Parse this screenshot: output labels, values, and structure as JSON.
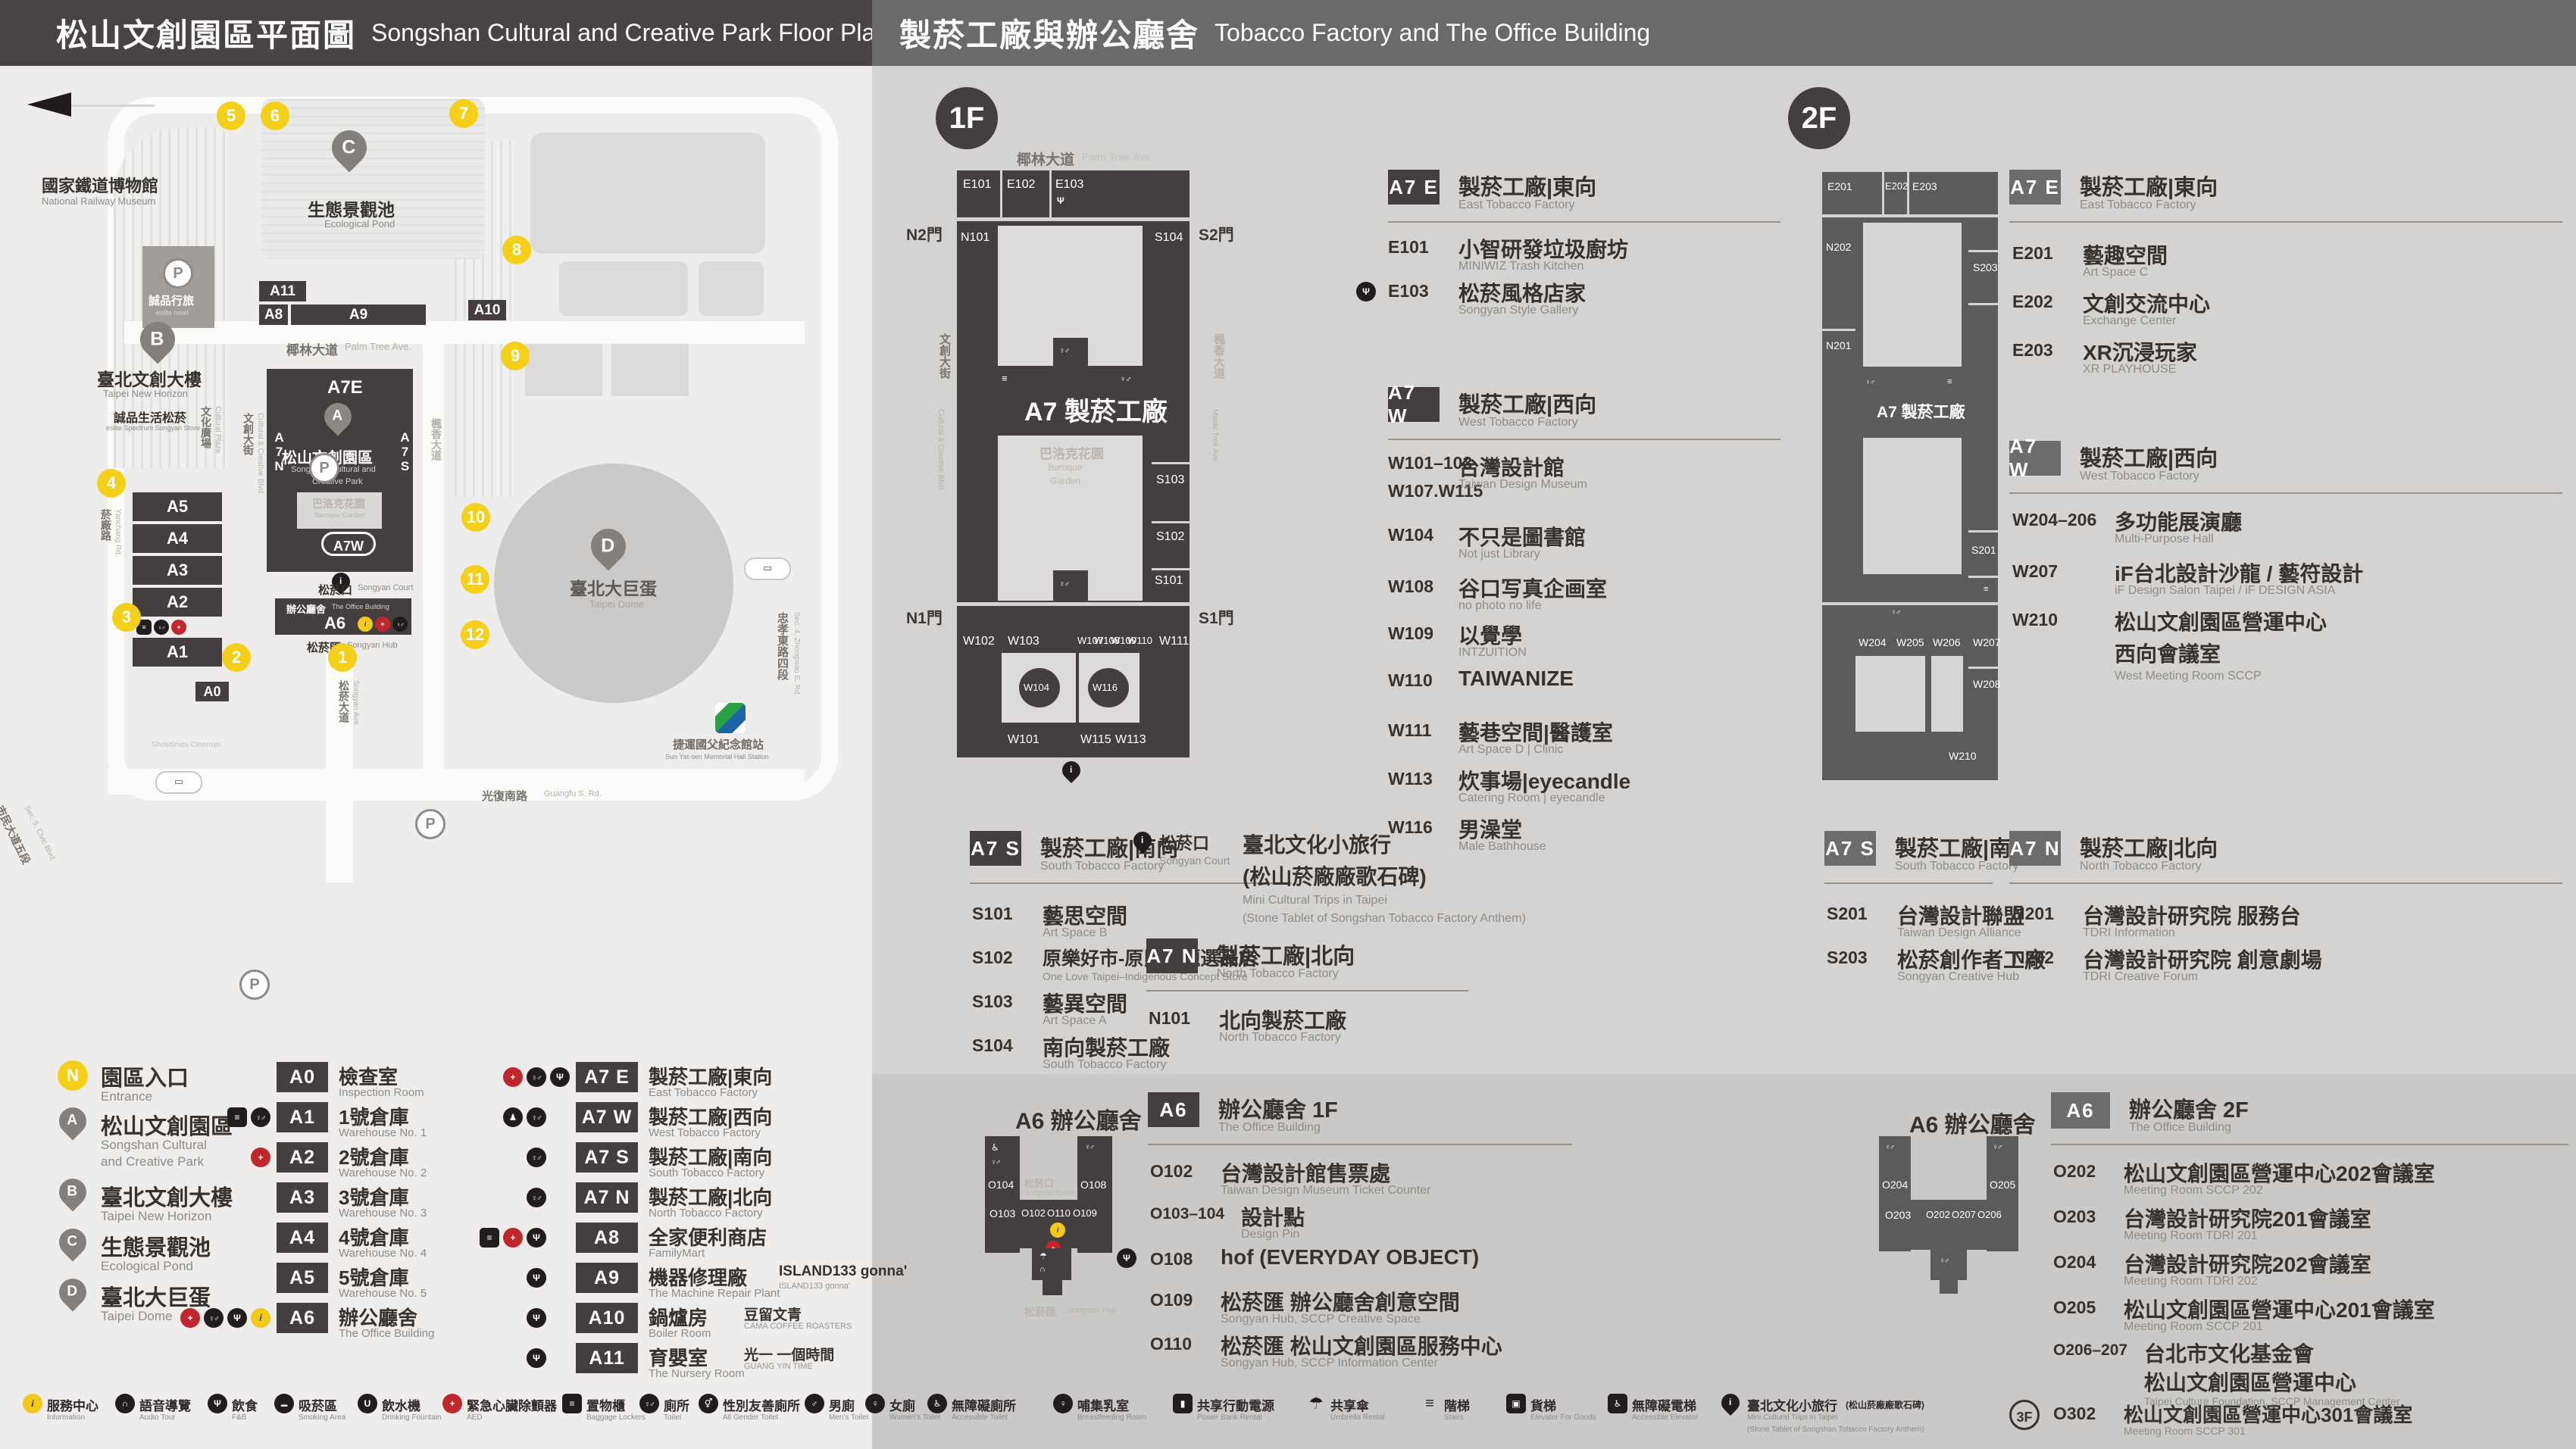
{
  "header_left": {
    "zh": "松山文創園區平面圖",
    "en": "Songshan Cultural and Creative Park Floor Plan"
  },
  "header_right": {
    "zh": "製菸工廠與辦公廳舍",
    "en": "Tobacco Factory and The Office Building"
  },
  "park": {
    "entrances": [
      "1",
      "2",
      "3",
      "4",
      "5",
      "6",
      "7",
      "8",
      "9",
      "10",
      "11",
      "12"
    ],
    "pins": {
      "a": "A",
      "b": "B",
      "c": "C",
      "d": "D"
    },
    "blocks": {
      "a0": "A0",
      "a1": "A1",
      "a2": "A2",
      "a3": "A3",
      "a4": "A4",
      "a5": "A5",
      "a6": "A6",
      "a8": "A8",
      "a9": "A9",
      "a10": "A10",
      "a11": "A11",
      "a7e": "A7E",
      "a7w": "A7W",
      "a7n": "A7N",
      "a7s": "A7S"
    },
    "labels": {
      "railway_museum_zh": "國家鐵道博物館",
      "railway_museum_en": "National Railway Museum",
      "pond_zh": "生態景觀池",
      "pond_en": "Ecological Pond",
      "eslite_hotel_zh": "誠品行旅",
      "eslite_hotel_en": "eslite hotel",
      "new_horizon_zh": "臺北文創大樓",
      "new_horizon_en": "Taipei New Horizon",
      "eslite_spectrum_zh": "誠品生活松菸",
      "eslite_spectrum_en": "eslite Spectrum Songyan Store",
      "park_zh": "松山文創園區",
      "park_en1": "Songshan Cultural and",
      "park_en2": "Creative Park",
      "baroque_zh": "巴洛克花園",
      "baroque_en": "Baroque Garden",
      "court_zh": "松菸口",
      "court_en": "Songyan Court",
      "office_zh": "辦公廳舍",
      "office_en": "The Office Building",
      "hub_zh": "松菸匯",
      "hub_en": "Songyan Hub",
      "dome_zh": "臺北大巨蛋",
      "dome_en": "Taipei Dome",
      "garden_city": "遠東Garden City",
      "showtimes_zh": "秀泰影城",
      "showtimes_en": "Showtimes Cinemas",
      "hotel_ic": "臺北洲際酒店",
      "dome_center": "巨蛋國際中心",
      "mrt_zh": "捷運國父紀念館站",
      "mrt_en": "Sun Yat-sen Memorial Hall Station"
    },
    "streets": {
      "palm_zh": "椰林大道",
      "palm_en": "Palm Tree Ave.",
      "cultural_blvd_zh": "文創大街",
      "cultural_blvd_en": "Cultural & Creative Blvd.",
      "cultural_plaza_zh": "文化廣場",
      "cultural_plaza_en": "Cultural Plaza",
      "yanchang_zh": "菸廠路",
      "yanchang_en": "Yanchang Rd.",
      "civic_zh": "市民大道五段",
      "civic_en": "Sec. 5, Civic Blvd.",
      "maple_zh": "楓香大道",
      "maple_en": "Maple Tree Ave.",
      "songyan_zh": "松菸大道",
      "songyan_en": "Songyan Ave.",
      "zhongxiao_zh": "忠孝東路四段",
      "zhongxiao_en": "Sec. 4, Zhongxiao E. Rd.",
      "guangfu_zh": "光復南路",
      "guangfu_en": "Guangfu S. Rd."
    }
  },
  "legend": {
    "points": [
      {
        "badge": "N",
        "zh": "園區入口",
        "en": "Entrance"
      },
      {
        "badge": "A",
        "zh": "松山文創園區",
        "en1": "Songshan Cultural",
        "en2": "and Creative Park"
      },
      {
        "badge": "B",
        "zh": "臺北文創大樓",
        "en": "Taipei New Horizon"
      },
      {
        "badge": "C",
        "zh": "生態景觀池",
        "en": "Ecological Pond"
      },
      {
        "badge": "D",
        "zh": "臺北大巨蛋",
        "en": "Taipei Dome"
      }
    ],
    "blocks": [
      {
        "code": "A0",
        "zh": "檢查室",
        "en": "Inspection Room"
      },
      {
        "code": "A1",
        "zh": "1號倉庫",
        "en": "Warehouse No. 1"
      },
      {
        "code": "A2",
        "zh": "2號倉庫",
        "en": "Warehouse No. 2"
      },
      {
        "code": "A3",
        "zh": "3號倉庫",
        "en": "Warehouse No. 3"
      },
      {
        "code": "A4",
        "zh": "4號倉庫",
        "en": "Warehouse No. 4"
      },
      {
        "code": "A5",
        "zh": "5號倉庫",
        "en": "Warehouse No. 5"
      },
      {
        "code": "A6",
        "zh": "辦公廳舍",
        "en": "The Office Building"
      }
    ],
    "areas": [
      {
        "code": "A7 E",
        "zh": "製菸工廠|東向",
        "en": "East Tobacco Factory"
      },
      {
        "code": "A7 W",
        "zh": "製菸工廠|西向",
        "en": "West Tobacco Factory"
      },
      {
        "code": "A7 S",
        "zh": "製菸工廠|南向",
        "en": "South Tobacco Factory"
      },
      {
        "code": "A7 N",
        "zh": "製菸工廠|北向",
        "en": "North Tobacco Factory"
      },
      {
        "code": "A8",
        "zh": "全家便利商店",
        "en": "FamilyMart"
      },
      {
        "code": "A9",
        "zh": "機器修理廠",
        "brand": "ISLAND133 gonna'",
        "brand_en": "ISLAND133 gonna'",
        "en": "The Machine Repair Plant"
      },
      {
        "code": "A10",
        "zh": "鍋爐房",
        "brand": "豆留文青",
        "brand_en": "CAMA COFFEE ROASTERS",
        "en": "Boiler Room"
      },
      {
        "code": "A11",
        "zh": "育嬰室",
        "brand": "光一 一個時間",
        "brand_en": "GUANG YIN TIME",
        "en": "The Nursery Room"
      }
    ]
  },
  "facilities_left": [
    {
      "zh": "服務中心",
      "en": "Information"
    },
    {
      "zh": "語音導覽",
      "en": "Audio Tour"
    },
    {
      "zh": "飲食",
      "en": "F&B"
    },
    {
      "zh": "吸菸區",
      "en": "Smoking Area"
    },
    {
      "zh": "飲水機",
      "en": "Drinking Fountain"
    },
    {
      "zh": "緊急心臟除顫器",
      "en": "AED"
    },
    {
      "zh": "置物櫃",
      "en": "Baggage Lockers"
    },
    {
      "zh": "廁所",
      "en": "Toilet"
    },
    {
      "zh": "性別友善廁所",
      "en": "All Gender Toilet"
    },
    {
      "zh": "男廁",
      "en": "Men's Toilet"
    },
    {
      "zh": "女廁",
      "en": "Women's Toilet"
    },
    {
      "zh": "無障礙廁所",
      "en": "Accessible Toilet"
    }
  ],
  "facilities_right": [
    {
      "zh": "哺集乳室",
      "en": "Breastfeeding Room"
    },
    {
      "zh": "共享行動電源",
      "en": "Power Bank Rental"
    },
    {
      "zh": "共享傘",
      "en": "Umbrella Rental"
    },
    {
      "zh": "階梯",
      "en": "Stairs"
    },
    {
      "zh": "貨梯",
      "en": "Elevator For Goods"
    },
    {
      "zh": "無障礙電梯",
      "en": "Accessible Elevator"
    },
    {
      "zh": "臺北文化小旅行",
      "zh2": "(松山菸廠廠歌石碑)",
      "en": "Mini Cultural Trips in Taipei",
      "en2": "(Stone Tablet of Songshan Tobacco Factory Anthem)"
    }
  ],
  "floor1": {
    "badge": "1F",
    "map": {
      "label": "A7 製菸工廠",
      "garden_zh": "巴洛克花園",
      "garden_en1": "Baroque",
      "garden_en2": "Garden",
      "street_top_zh": "椰林大道",
      "street_top_en": "Palm Tree Ave.",
      "street_left_zh": "文創大街",
      "street_left_en": "Cultural & Creative Blvd.",
      "street_right_zh": "楓香大道",
      "street_right_en": "Maple Tree Ave.",
      "doors": {
        "n2": "N2門",
        "s2": "S2門",
        "n1": "N1門",
        "s1": "S1門"
      },
      "rooms": {
        "E101": "E101",
        "E102": "E102",
        "E103": "E103",
        "N101": "N101",
        "S104": "S104",
        "S103": "S103",
        "S102": "S102",
        "S101": "S101",
        "W102": "W102",
        "W103": "W103",
        "W107": "W107",
        "W108": "W108",
        "W109": "W109",
        "W110": "W110",
        "W111": "W111",
        "W104": "W104",
        "W116": "W116",
        "W101": "W101",
        "W115": "W115",
        "W113": "W113"
      },
      "a6_title": "A6 辦公廳舍",
      "a6_court_zh": "松菸口",
      "a6_court_en": "Songyan Court",
      "a6_hub_zh": "松菸匯",
      "a6_hub_en": "Songyan Hub",
      "a6_rooms": {
        "O104": "O104",
        "O108": "O108",
        "O103": "O103",
        "O102": "O102",
        "O110": "O110",
        "O109": "O109"
      }
    },
    "east": {
      "code": "A7 E",
      "zh": "製菸工廠|東向",
      "en": "East Tobacco Factory",
      "items": [
        {
          "code": "E101",
          "zh": "小智研發垃圾廚坊",
          "en": "MINIWIZ Trash Kitchen"
        },
        {
          "code": "E103",
          "zh": "松菸風格店家",
          "en": "Songyan Style Gallery"
        }
      ]
    },
    "west": {
      "code": "A7 W",
      "zh": "製菸工廠|西向",
      "en": "West Tobacco Factory",
      "items": [
        {
          "code1": "W101–103",
          "code2": "W107.W115",
          "zh": "台灣設計館",
          "en": "Taiwan Design Museum"
        },
        {
          "code": "W104",
          "zh": "不只是圖書館",
          "en": "Not just Library"
        },
        {
          "code": "W108",
          "zh": "谷口写真企画室",
          "en": "no photo no life"
        },
        {
          "code": "W109",
          "zh": "以覺學",
          "en": "INTZUITION"
        },
        {
          "code": "W110",
          "zh": "TAIWANIZE",
          "en": ""
        },
        {
          "code": "W111",
          "zh": "藝巷空間|醫護室",
          "en": "Art Space D | Clinic"
        },
        {
          "code": "W113",
          "zh": "炊事場|eyecandle",
          "en": "Catering Room | eyecandle"
        },
        {
          "code": "W116",
          "zh": "男澡堂",
          "en": "Male Bathhouse"
        }
      ]
    },
    "south": {
      "code": "A7 S",
      "zh": "製菸工廠|南向",
      "en": "South Tobacco Factory",
      "items": [
        {
          "code": "S101",
          "zh": "藝思空間",
          "en": "Art Space B"
        },
        {
          "code": "S102",
          "zh": "原樂好市-原民主題選品店",
          "en": "One Love Taipei–Indigenous Concept Store"
        },
        {
          "code": "S103",
          "zh": "藝異空間",
          "en": "Art Space A"
        },
        {
          "code": "S104",
          "zh": "南向製菸工廠",
          "en": "South Tobacco Factory"
        }
      ]
    },
    "court": {
      "zh": "松菸口",
      "en": "Songyan Court",
      "name1": "臺北文化小旅行",
      "name2": "(松山菸廠廠歌石碑)",
      "en1": "Mini Cultural Trips in Taipei",
      "en2": "(Stone Tablet of Songshan Tobacco Factory Anthem)"
    },
    "north": {
      "code": "A7 N",
      "zh": "製菸工廠|北向",
      "en": "North Tobacco Factory",
      "items": [
        {
          "code": "N101",
          "zh": "北向製菸工廠",
          "en": "North Tobacco Factory"
        }
      ]
    },
    "office": {
      "code": "A6",
      "zh": "辦公廳舍 1F",
      "en": "The Office Building",
      "items": [
        {
          "code": "O102",
          "zh": "台灣設計館售票處",
          "en": "Taiwan Design Museum Ticket Counter"
        },
        {
          "code": "O103–104",
          "zh": "設計點",
          "en": "Design Pin"
        },
        {
          "code": "O108",
          "zh": "hof (EVERYDAY OBJECT)",
          "en": ""
        },
        {
          "code": "O109",
          "zh": "松菸匯 辦公廳舍創意空間",
          "en": "Songyan Hub, SCCP Creative Space"
        },
        {
          "code": "O110",
          "zh": "松菸匯 松山文創園區服務中心",
          "en": "Songyan Hub, SCCP Information Center"
        }
      ]
    }
  },
  "floor2": {
    "badge": "2F",
    "map": {
      "label": "A7 製菸工廠",
      "rooms": {
        "E201": "E201",
        "E202": "E202",
        "E203": "E203",
        "N202": "N202",
        "N201": "N201",
        "S203": "S203",
        "S201": "S201",
        "W204": "W204",
        "W205": "W205",
        "W206": "W206",
        "W207": "W207",
        "W208": "W208",
        "W210": "W210"
      },
      "a6_title": "A6 辦公廳舍",
      "a6_rooms": {
        "O204": "O204",
        "O205": "O205",
        "O203": "O203",
        "O202": "O202",
        "O207": "O207",
        "O206": "O206"
      }
    },
    "east": {
      "code": "A7 E",
      "zh": "製菸工廠|東向",
      "en": "East Tobacco Factory",
      "items": [
        {
          "code": "E201",
          "zh": "藝趣空間",
          "en": "Art Space C"
        },
        {
          "code": "E202",
          "zh": "文創交流中心",
          "en": "Exchange Center"
        },
        {
          "code": "E203",
          "zh": "XR沉浸玩家",
          "en": "XR PLAYHOUSE"
        }
      ]
    },
    "west": {
      "code": "A7 W",
      "zh": "製菸工廠|西向",
      "en": "West Tobacco Factory",
      "items": [
        {
          "code": "W204–206",
          "zh": "多功能展演廳",
          "en": "Multi-Purpose Hall"
        },
        {
          "code": "W207",
          "zh": "iF台北設計沙龍 / 藝符設計",
          "en": "iF Design Salon Taipei / iF DESIGN ASIA"
        },
        {
          "code": "W210",
          "zh1": "松山文創園區營運中心",
          "zh2": "西向會議室",
          "en": "West Meeting Room SCCP"
        }
      ]
    },
    "south": {
      "code": "A7 S",
      "zh": "製菸工廠|南向",
      "en": "South Tobacco Factory",
      "items": [
        {
          "code": "S201",
          "zh": "台灣設計聯盟",
          "en": "Taiwan Design Alliance"
        },
        {
          "code": "S203",
          "zh": "松菸創作者工廠",
          "en": "Songyan Creative Hub"
        }
      ]
    },
    "north": {
      "code": "A7 N",
      "zh": "製菸工廠|北向",
      "en": "North Tobacco Factory",
      "items": [
        {
          "code": "N201",
          "zh": "台灣設計研究院 服務台",
          "en": "TDRI Information"
        },
        {
          "code": "N202",
          "zh": "台灣設計研究院 創意劇場",
          "en": "TDRI Creative Forum"
        }
      ]
    },
    "office": {
      "code": "A6",
      "zh": "辦公廳舍 2F",
      "en": "The Office Building",
      "items": [
        {
          "code": "O202",
          "zh": "松山文創園區營運中心202會議室",
          "en": "Meeting Room SCCP 202"
        },
        {
          "code": "O203",
          "zh": "台灣設計研究院201會議室",
          "en": "Meeting Room TDRI 201"
        },
        {
          "code": "O204",
          "zh": "台灣設計研究院202會議室",
          "en": "Meeting Room TDRI 202"
        },
        {
          "code": "O205",
          "zh": "松山文創園區營運中心201會議室",
          "en": "Meeting Room SCCP 201"
        },
        {
          "code": "O206–207",
          "zh1": "台北市文化基金會",
          "zh2": "松山文創園區營運中心",
          "en": "Taipei Culture Foundation, SCCP Management Center"
        }
      ],
      "floor3": {
        "badge": "3F",
        "code": "O302",
        "zh": "松山文創園區營運中心301會議室",
        "en": "Meeting Room SCCP 301"
      }
    }
  }
}
